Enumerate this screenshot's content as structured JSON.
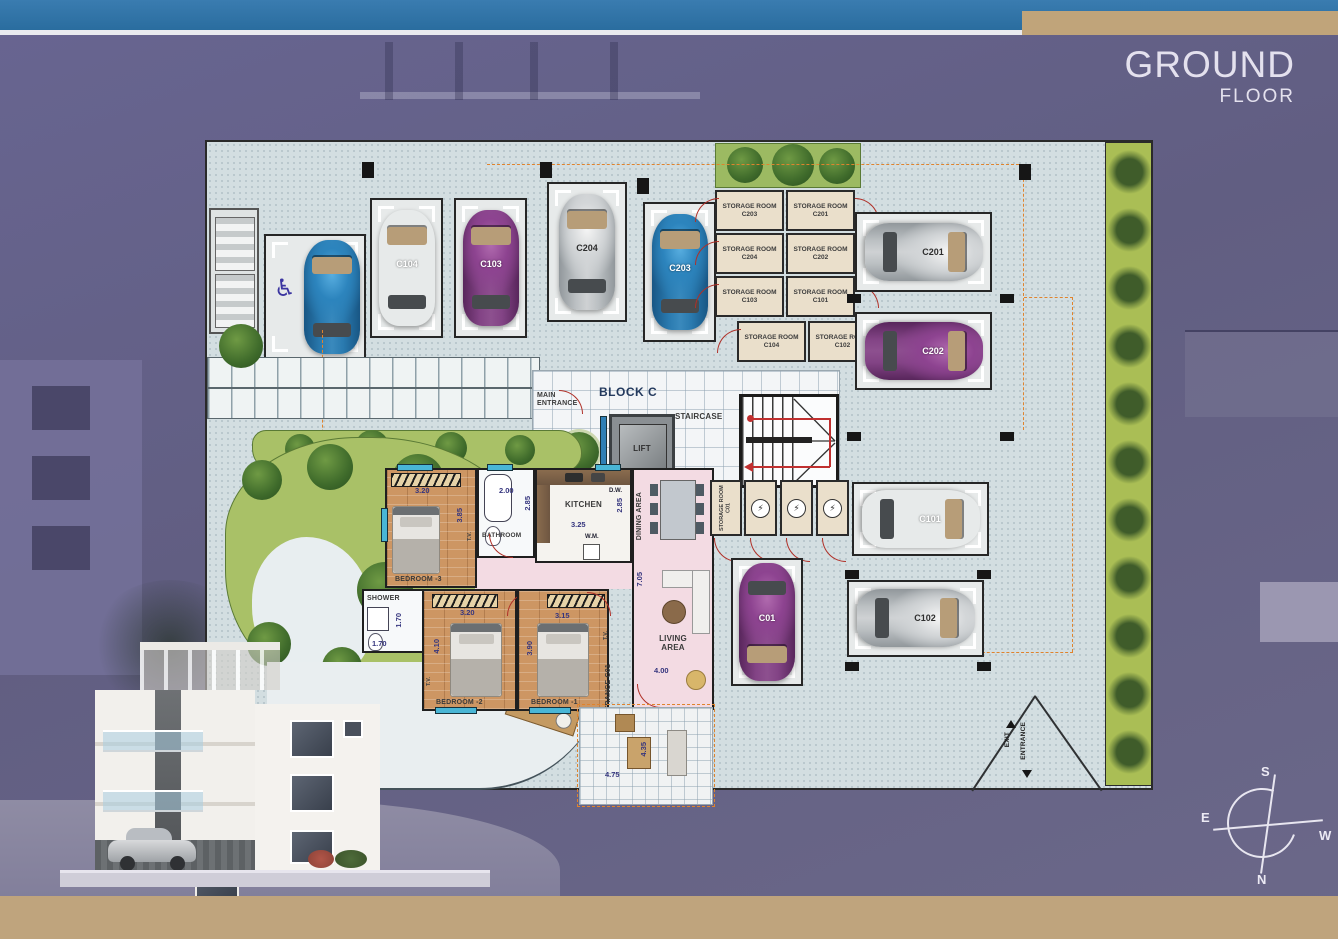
{
  "header": {
    "title_line1": "GROUND",
    "title_line2": "FLOOR"
  },
  "colors": {
    "top_bar": "#2e73a6",
    "tan_bar": "#bfa47d",
    "plan_paving": "#d3dee1",
    "garden_green": "#a9c167",
    "dashed_boundary": "#e0832c",
    "pink_floor": "#f3dbe3",
    "storage_beige": "#eadfcb",
    "door_arc_red": "#b03028"
  },
  "plan": {
    "block_label": "BLOCK C",
    "main_entrance_label": "MAIN ENTRANCE",
    "staircase_label": "STAIRCASE",
    "lift_label": "LIFT",
    "entrance_unit_label": "ENTRANCE C01",
    "storage_c01_label": "STORAGE ROOM C01",
    "exit_label": "EXIT",
    "entrance_label": "ENTRANCE"
  },
  "compass": {
    "n": "N",
    "s": "S",
    "e": "E",
    "w": "W"
  },
  "icons": {
    "handicap": "♿",
    "electric": "⚡"
  },
  "parking": [
    {
      "id": "accessible",
      "label": "",
      "color": "#2c84bd"
    },
    {
      "id": "C104",
      "label": "C104",
      "color": "#d03a2b"
    },
    {
      "id": "C103",
      "label": "C103",
      "color": "#8d4390"
    },
    {
      "id": "C204",
      "label": "C204",
      "color": "#d3d6d8"
    },
    {
      "id": "C203",
      "label": "C203",
      "color": "#2c84bd"
    },
    {
      "id": "C201",
      "label": "C201",
      "color": "#d3d6d8"
    },
    {
      "id": "C202",
      "label": "C202",
      "color": "#8d4390"
    },
    {
      "id": "C101",
      "label": "C101",
      "color": "#d03a2b"
    },
    {
      "id": "C01",
      "label": "C01",
      "color": "#8d4390"
    },
    {
      "id": "C102",
      "label": "C102",
      "color": "#d3d6d8"
    }
  ],
  "storage_rooms": [
    {
      "label": "STORAGE ROOM C203"
    },
    {
      "label": "STORAGE ROOM C201"
    },
    {
      "label": "STORAGE ROOM C204"
    },
    {
      "label": "STORAGE ROOM C202"
    },
    {
      "label": "STORAGE ROOM C103"
    },
    {
      "label": "STORAGE ROOM C101"
    },
    {
      "label": "STORAGE ROOM C104"
    },
    {
      "label": "STORAGE ROOM C102"
    }
  ],
  "rooms": {
    "bedroom3": {
      "label": "BEDROOM -3",
      "dim_w": "3.20",
      "dim_h": "3.85"
    },
    "bedroom2": {
      "label": "BEDROOM -2",
      "dim_w": "3.20",
      "dim_h": "4.10"
    },
    "bedroom1": {
      "label": "BEDROOM -1",
      "dim_w": "3.15",
      "dim_h": "3.90"
    },
    "bathroom": {
      "label": "BATHROOM",
      "dim_w": "2.00",
      "dim_h": "2.85"
    },
    "kitchen": {
      "label": "KITCHEN",
      "dim_w": "3.25",
      "dim_h": "2.85",
      "dishwasher": "D.W.",
      "washing_machine": "W.M."
    },
    "dining": {
      "label": "DINING AREA"
    },
    "living": {
      "label": "LIVING AREA",
      "dim_w": "4.00",
      "dim_h": "7.05"
    },
    "shower": {
      "label": "SHOWER",
      "dim": "1.70"
    },
    "tv_label": "T.V.",
    "terrace": {
      "dim_w": "4.75",
      "dim_h": "4.35"
    }
  }
}
